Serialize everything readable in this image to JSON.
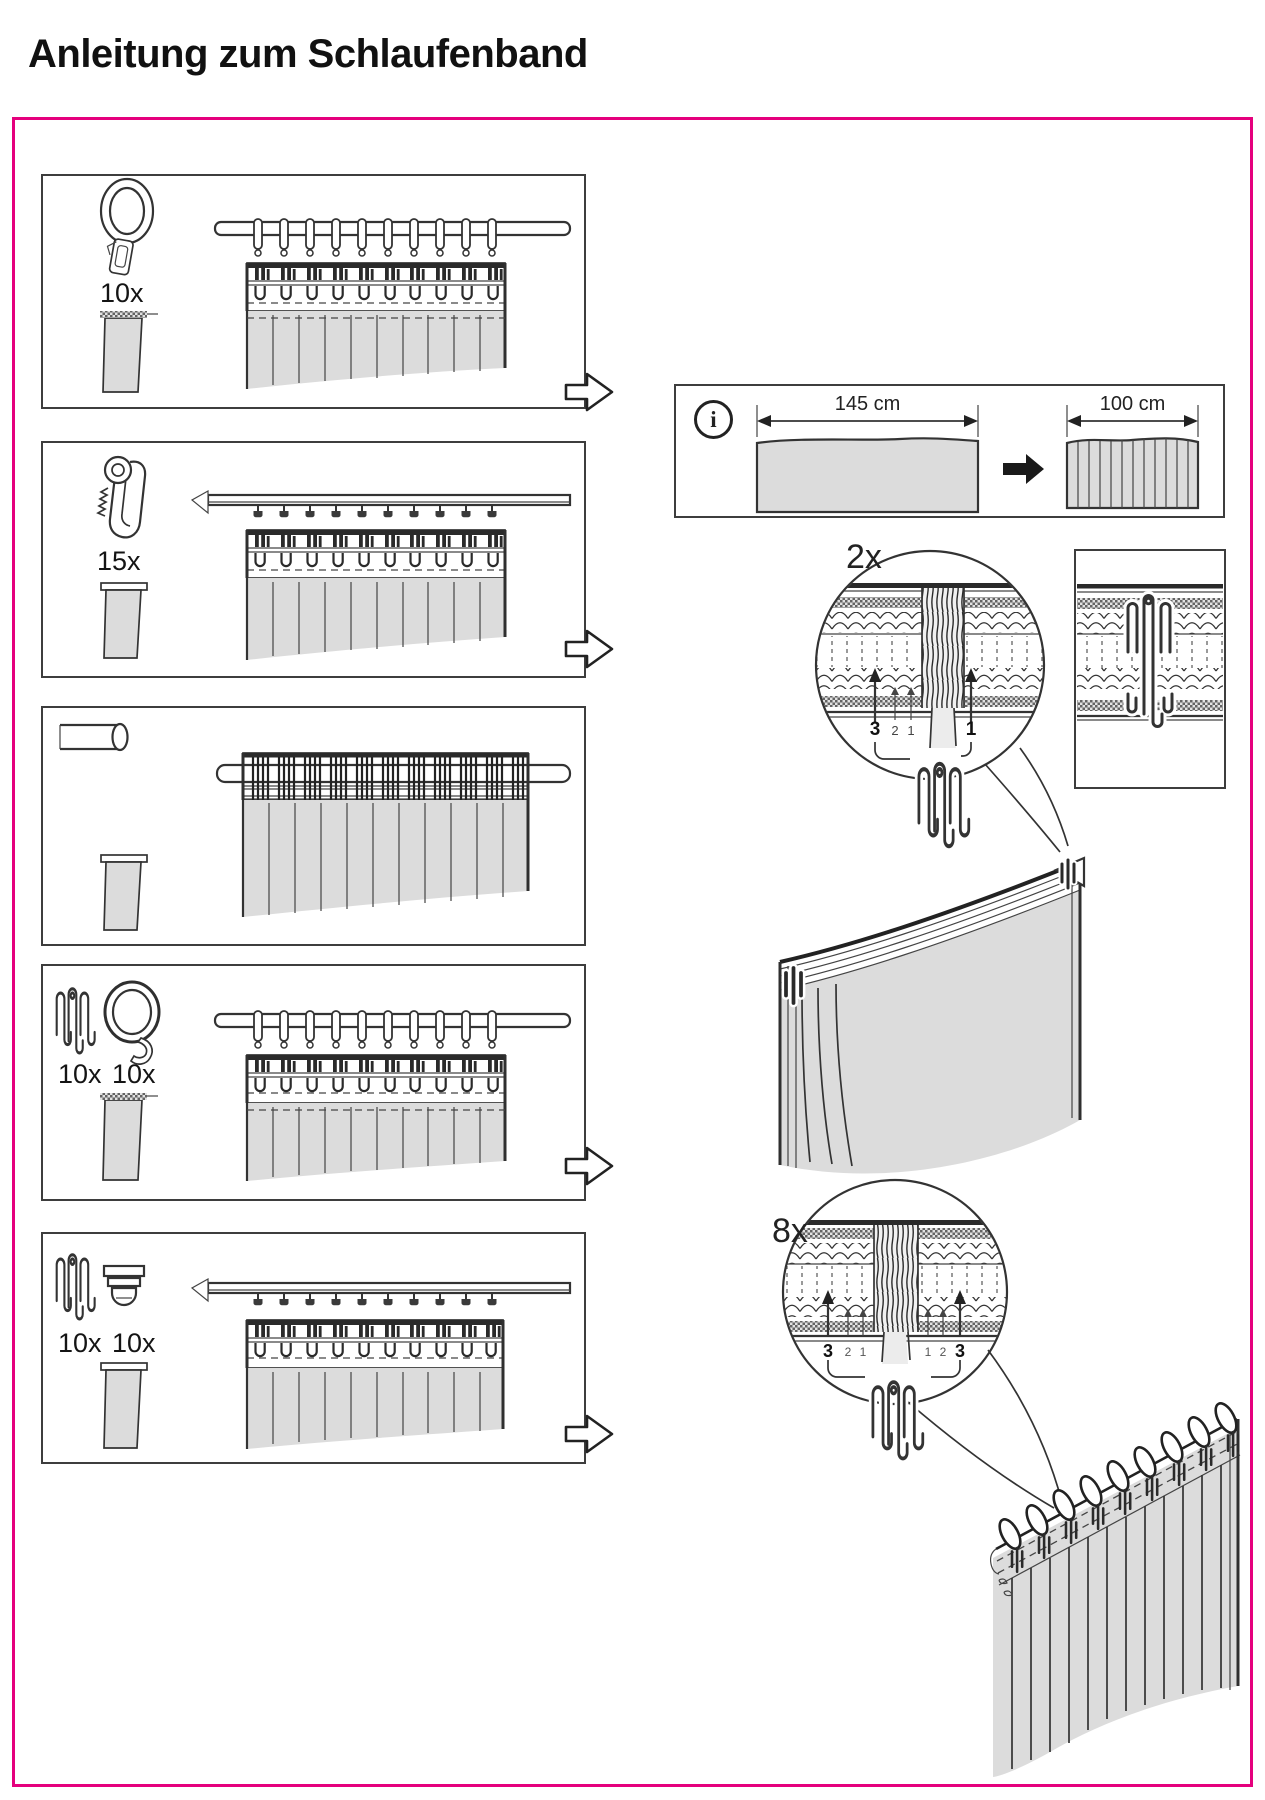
{
  "title": "Anleitung zum Schlaufenband",
  "colors": {
    "accent_pink": "#e5007d",
    "fabric_gray": "#dcdcdc",
    "line_dark": "#333333"
  },
  "panels": [
    {
      "name": "clip-rings-on-rod",
      "count1": "10x"
    },
    {
      "name": "gliders-on-track",
      "count1": "15x"
    },
    {
      "name": "rod-through-loop-band"
    },
    {
      "name": "pleat-hooks-and-rings-on-rod",
      "count1": "10x",
      "count2": "10x"
    },
    {
      "name": "pleat-hooks-and-gliders-on-track",
      "count1": "10x",
      "count2": "10x"
    }
  ],
  "info_box": {
    "icon": "i",
    "width_flat": "145 cm",
    "width_gathered": "100 cm"
  },
  "detail_2x": {
    "label": "2x",
    "pockets_left": [
      "3",
      "2",
      "1"
    ],
    "pockets_right": [
      "1"
    ]
  },
  "detail_8x": {
    "label": "8x",
    "pockets_left": [
      "3",
      "2",
      "1"
    ],
    "pockets_right": [
      "1",
      "2",
      "3"
    ]
  }
}
